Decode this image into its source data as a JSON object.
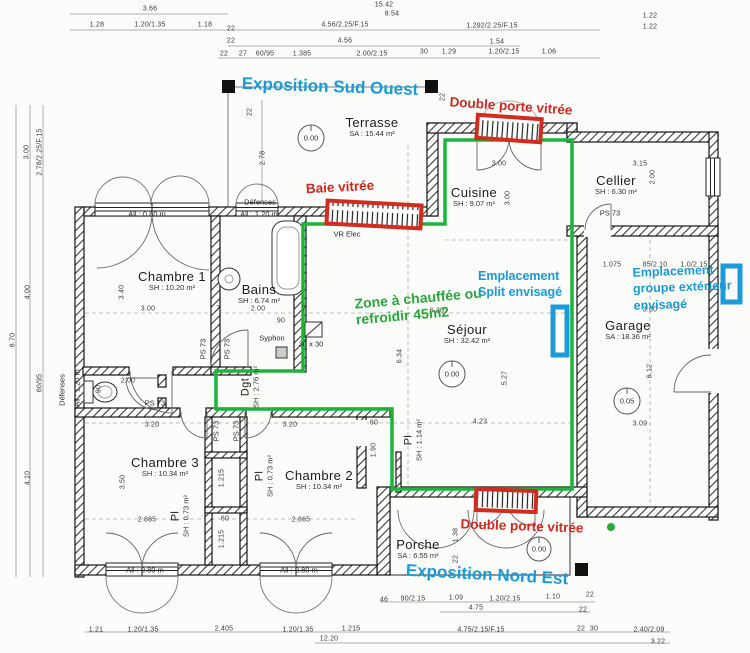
{
  "colors": {
    "annotation_blue": "#1b9ad6",
    "annotation_red": "#cd2a21",
    "annotation_green": "#2aa63c",
    "zone_line_green": "#1db43b",
    "unit_marker_blue": "#1d9bd8"
  },
  "annotations": {
    "exposition_sw": "Exposition Sud Ouest",
    "exposition_ne": "Exposition Nord Est",
    "double_porte_top": "Double porte vitrée",
    "double_porte_bottom": "Double porte vitrée",
    "baie_vitree": "Baie vitrée",
    "zone_l1": "Zone à chauffée ou",
    "zone_l2": "refroidir 45m2",
    "split_l1": "Emplacement",
    "split_l2": "Split envisagé",
    "groupe_l1": "Emplacement",
    "groupe_l2": "groupe extérieur",
    "groupe_l3": "envisagé"
  },
  "rooms": [
    {
      "name": "Terrasse",
      "area": "SA : 15.44 m²"
    },
    {
      "name": "Cuisine",
      "area": "SH : 9.07 m²"
    },
    {
      "name": "Cellier",
      "area": "SH : 6.30 m²"
    },
    {
      "name": "Chambre 1",
      "area": "SH : 10.20 m²"
    },
    {
      "name": "Bains",
      "area": "SH : 6.74 m²"
    },
    {
      "name": "Séjour",
      "area": "SH : 32.42 m²"
    },
    {
      "name": "Garage",
      "area": "SA : 18.36 m²"
    },
    {
      "name": "Dgt",
      "area": "SH : 2.76 m²"
    },
    {
      "name": "Chambre 3",
      "area": "SH : 10.34 m²"
    },
    {
      "name": "Pl",
      "area": "SH : 0.73 m²"
    },
    {
      "name": "Chambre 2",
      "area": "SH : 10.34 m²"
    },
    {
      "name": "Pl",
      "area": "SH : 0.73 m²"
    },
    {
      "name": "Pl",
      "area": "SH : 1.14 m²"
    },
    {
      "name": "Porche",
      "area": "SA : 6.55 m²"
    }
  ],
  "levels": [
    "0.00",
    "0.00",
    "0.05",
    "0.00"
  ],
  "plan_labels": [
    "VR Elec",
    "Défenses",
    "Défenses",
    "PS 73",
    "PS 73",
    "PS 73",
    "PS 73",
    "PS 73",
    "PS 73",
    "Syphon",
    "30 x 30",
    "All : 0.80 m",
    "All : 1.20 m",
    "All : 0.80 m",
    "All : 0.80 m",
    "All : 1.20 m"
  ],
  "dims": [
    "3.66",
    "1.28",
    "1.20/1.35",
    "1.18",
    "22",
    "4.56/2.25/F.15",
    "22",
    "4.56",
    "22",
    "27",
    "60/95",
    "1.385",
    "2.00/2.15",
    "15.42",
    "8.54",
    "1.292/2.25/F.15",
    "1.54",
    "30",
    "1.29",
    "1.20/2.15",
    "1.06",
    "1.22",
    "1.22",
    "3.00",
    "2.78/2.25/F.15",
    "4.00",
    "8.70",
    "60/95",
    "4.10",
    "2.78",
    "3.40",
    "3.00",
    "2.00",
    "90",
    "3.00",
    "3.00",
    "3.15",
    "1.075",
    "85/2.10",
    "1.0/2.15",
    "2.00",
    "6.30",
    "6.34",
    "5.27",
    "4.23",
    "3.00",
    "6.12",
    "3.09",
    "3.20",
    "3.20",
    "60",
    "1.90",
    "3.50",
    "1.215",
    "1.215",
    "2.865",
    "60",
    "2.865",
    "1.38",
    "22",
    "1.21",
    "1.20/1.35",
    "2.405",
    "1.20/1.35",
    "1.215",
    "12.20",
    "46",
    "90/2.15",
    "1.09",
    "1.20/2.15",
    "1.10",
    "22",
    "4.75",
    "22",
    "4.75/2.15/F.15",
    "22",
    "30",
    "2.40/2.09",
    "3.22",
    "22",
    "22",
    "7",
    "7",
    "2.00",
    "90"
  ]
}
